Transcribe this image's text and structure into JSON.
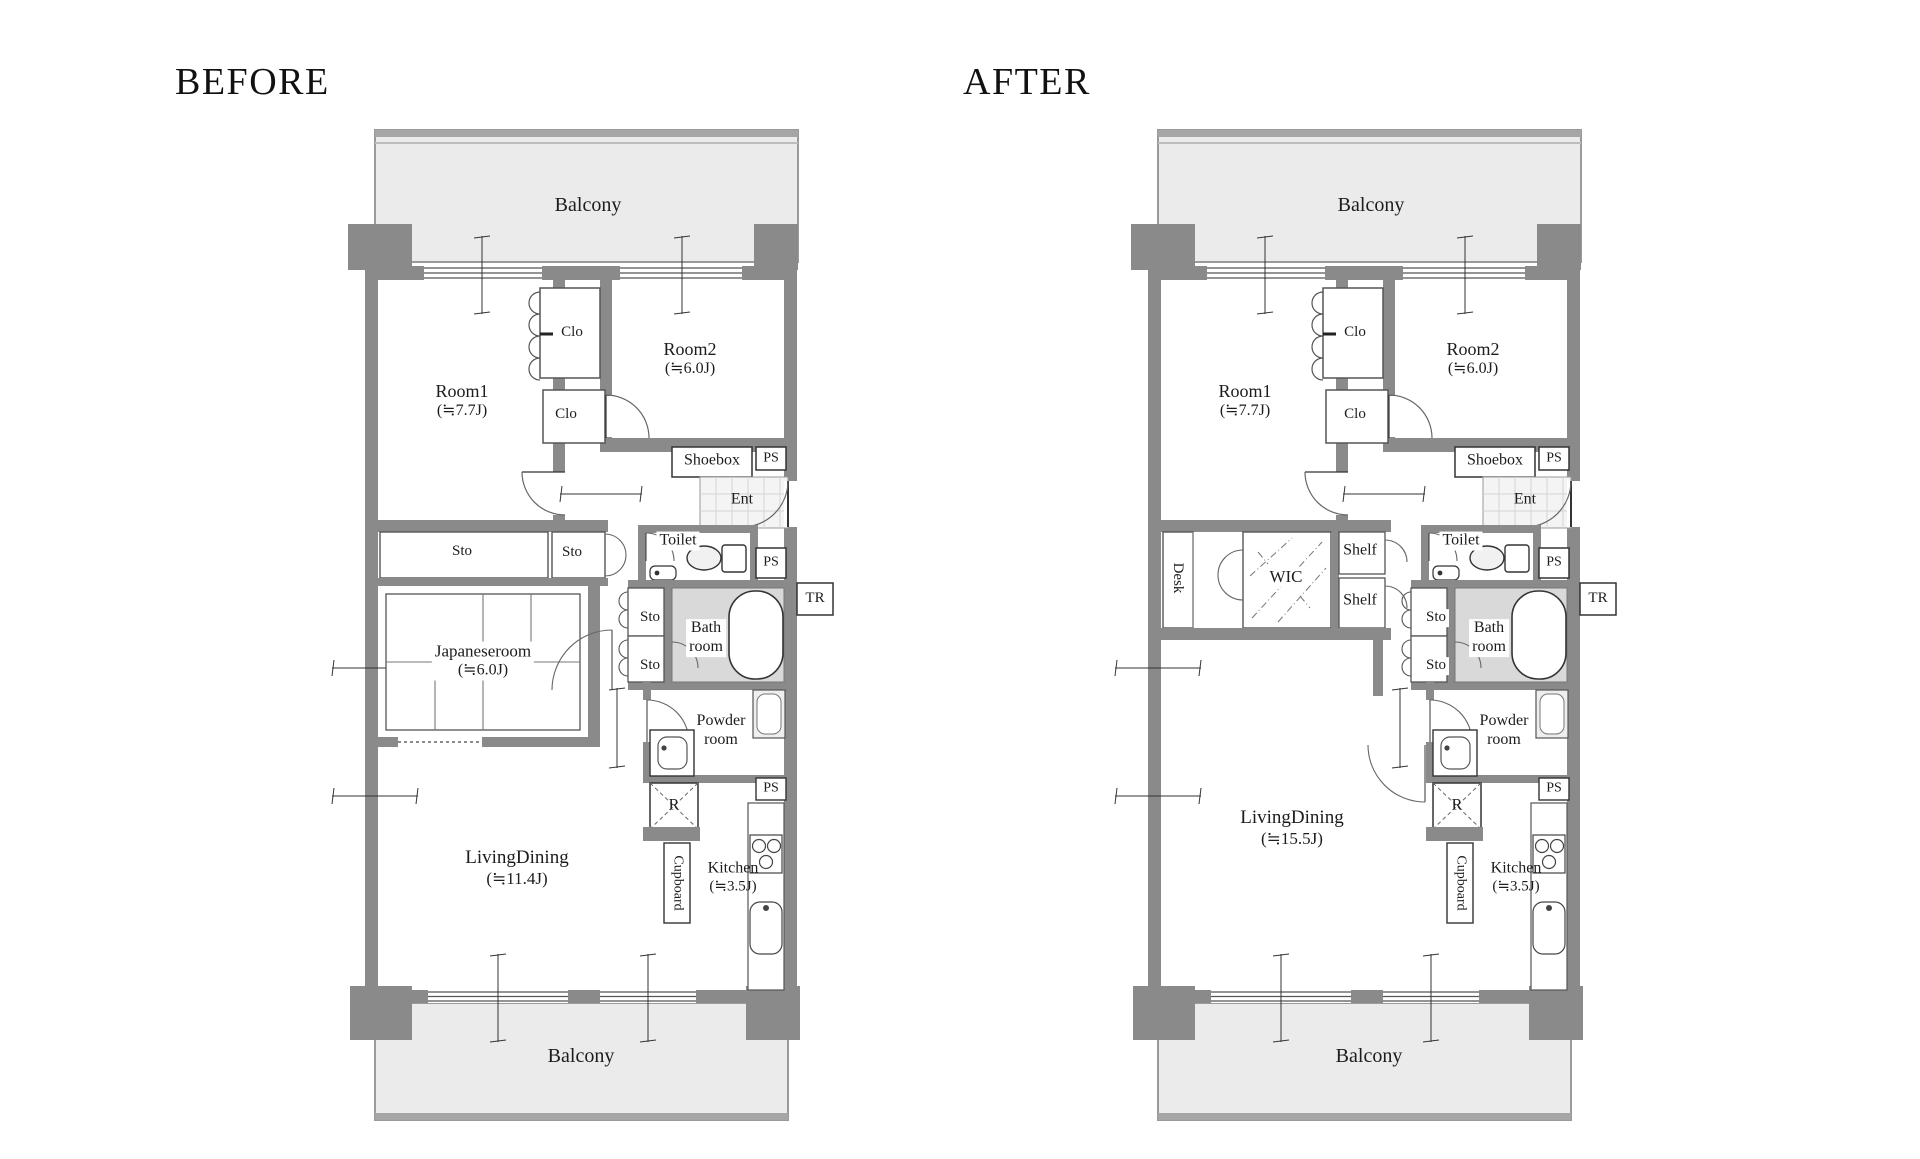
{
  "colors": {
    "wall": "#8a8a8a",
    "balcony_fill": "#ebebeb",
    "bath_floor": "#d9d9d9",
    "entrance_tile": "#f4f4f4",
    "text": "#1c1c1c"
  },
  "before": {
    "title": "BEFORE",
    "balcony_top": "Balcony",
    "balcony_bottom": "Balcony",
    "room1": {
      "name": "Room1",
      "size": "(≒7.7J)"
    },
    "room2": {
      "name": "Room2",
      "size": "(≒6.0J)"
    },
    "clo_upper": "Clo",
    "clo_lower": "Clo",
    "shoebox": "Shoebox",
    "ps_entrance": "PS",
    "ent": "Ent",
    "toilet": "Toilet",
    "ps_middle": "PS",
    "tr": "TR",
    "sto_wide": "Sto",
    "sto_hall": "Sto",
    "sto_bath_upper": "Sto",
    "sto_bath_lower": "Sto",
    "bathroom": {
      "line1": "Bath",
      "line2": "room"
    },
    "japaneseroom": {
      "name": "Japaneseroom",
      "size": "(≒6.0J)"
    },
    "powder_room": {
      "line1": "Powder",
      "line2": "room"
    },
    "refrigerator": "R",
    "ps_kitchen": "PS",
    "cupboard": "Cupboard",
    "kitchen": {
      "name": "Kitchen",
      "size": "(≒3.5J)"
    },
    "living_dining": {
      "name": "LivingDining",
      "size": "(≒11.4J)"
    }
  },
  "after": {
    "title": "AFTER",
    "balcony_top": "Balcony",
    "balcony_bottom": "Balcony",
    "room1": {
      "name": "Room1",
      "size": "(≒7.7J)"
    },
    "room2": {
      "name": "Room2",
      "size": "(≒6.0J)"
    },
    "clo_upper": "Clo",
    "clo_lower": "Clo",
    "shoebox": "Shoebox",
    "ps_entrance": "PS",
    "ent": "Ent",
    "toilet": "Toilet",
    "ps_middle": "PS",
    "tr": "TR",
    "desk": "Desk",
    "wic": "WIC",
    "shelf_upper": "Shelf",
    "shelf_lower": "Shelf",
    "sto_bath_upper": "Sto",
    "sto_bath_lower": "Sto",
    "bathroom": {
      "line1": "Bath",
      "line2": "room"
    },
    "powder_room": {
      "line1": "Powder",
      "line2": "room"
    },
    "refrigerator": "R",
    "ps_kitchen": "PS",
    "cupboard": "Cupboard",
    "kitchen": {
      "name": "Kitchen",
      "size": "(≒3.5J)"
    },
    "living_dining": {
      "name": "LivingDining",
      "size": "(≒15.5J)"
    }
  }
}
